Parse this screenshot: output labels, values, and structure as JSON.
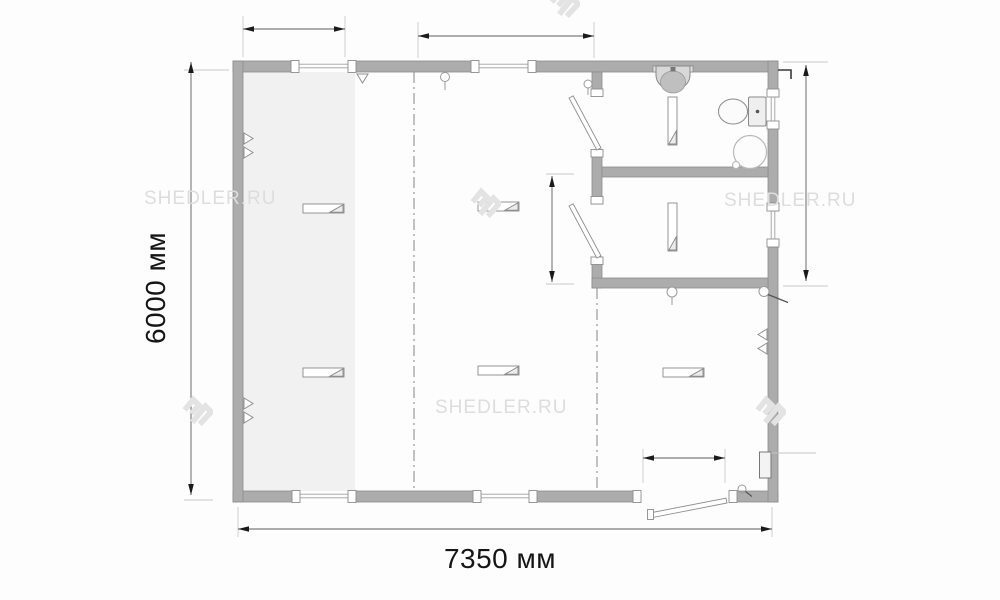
{
  "watermark": {
    "text": "SHEDLER.RU",
    "logo_icon": "shedler-logo-icon"
  },
  "dimensions": {
    "overall_width_label": "7350 мм",
    "overall_height_label": "6000 мм"
  },
  "plan": {
    "type": "floor-plan",
    "fixture_icons": [
      "sink-icon",
      "toilet-icon",
      "water-heater-icon",
      "heater-icon",
      "lamp-icon",
      "socket-icon",
      "electrical-panel-icon",
      "door-icon",
      "window-icon"
    ],
    "window_count": 6,
    "interior_door_count": 2,
    "entrance_door_count": 1
  },
  "colors": {
    "wall": "#acacac",
    "wall_stroke": "#8d8d8d",
    "shaded_zone": "#f1f1f1",
    "watermark": "#dddddd",
    "dimension_text": "#151515",
    "dimension_line": "#5a5a5a",
    "axis_line": "#909090",
    "background": "#fdfdfd"
  }
}
